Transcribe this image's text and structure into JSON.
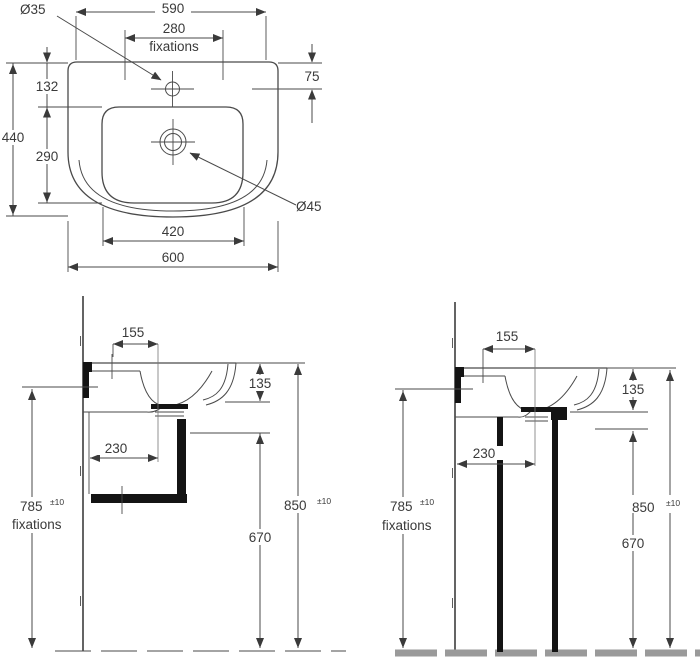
{
  "colors": {
    "background": "#ffffff",
    "line": "#4a4a4a",
    "text": "#3a3a3a",
    "thick": "#141414",
    "centerline": "#777777",
    "floor": "#9a9a9a"
  },
  "top_view": {
    "dia35": "Ø35",
    "dia45": "Ø45",
    "d590": "590",
    "d280": "280",
    "fixations_label": "fixations",
    "d75": "75",
    "d132": "132",
    "d440": "440",
    "d290": "290",
    "d420": "420",
    "d600": "600"
  },
  "side_view_wall_hung": {
    "d155": "155",
    "d135": "135",
    "d230": "230",
    "d670": "670",
    "d785": "785",
    "d785_tol": "±10",
    "fixations_label": "fixations",
    "d850": "850",
    "d850_tol": "±10"
  },
  "side_view_pedestal": {
    "d155": "155",
    "d135": "135",
    "d230": "230",
    "d670": "670",
    "d785": "785",
    "d785_tol": "±10",
    "fixations_label": "fixations",
    "d850": "850",
    "d850_tol": "±10"
  }
}
